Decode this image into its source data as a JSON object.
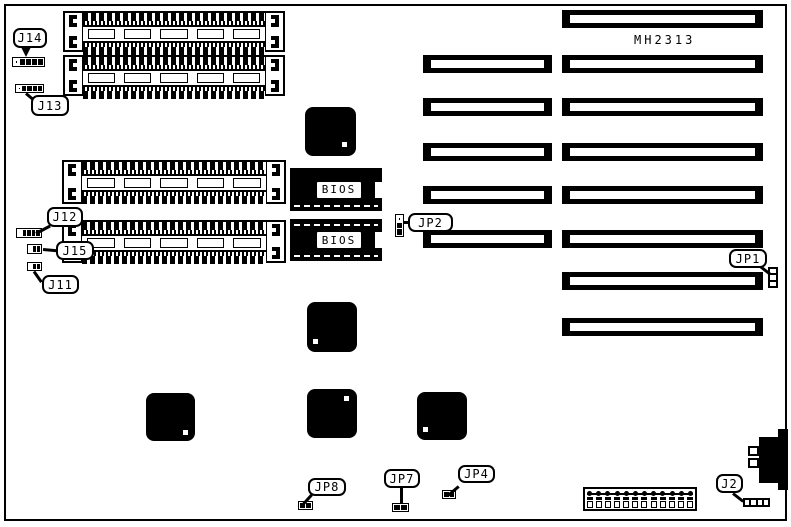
{
  "board": {
    "model_label": "MH2313",
    "colors": {
      "ink": "#000000",
      "background": "#ffffff"
    }
  },
  "bios": {
    "chip1_label": "BIOS",
    "chip2_label": "BIOS"
  },
  "callouts": {
    "j14": {
      "label": "J14"
    },
    "j13": {
      "label": "J13"
    },
    "j12": {
      "label": "J12"
    },
    "j15": {
      "label": "J15"
    },
    "j11": {
      "label": "J11"
    },
    "jp2": {
      "label": "JP2"
    },
    "jp1": {
      "label": "JP1"
    },
    "jp8": {
      "label": "JP8"
    },
    "jp7": {
      "label": "JP7"
    },
    "jp4": {
      "label": "JP4"
    },
    "j2": {
      "label": "J2"
    }
  }
}
